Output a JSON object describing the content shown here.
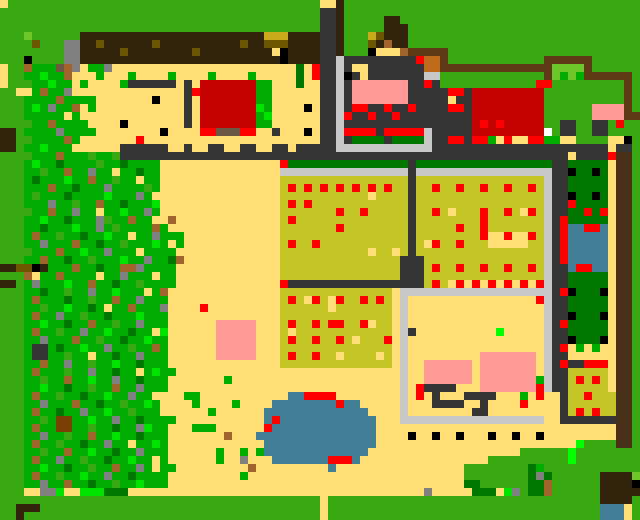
{
  "map": {
    "kind": "pixel-art-farm-map",
    "cell_size": 8,
    "grid": {
      "width": 80,
      "height": 65
    },
    "palette": {
      "G": "#38A811",
      "e": "#00AC00",
      "E": "#007800",
      "f": "#00E400",
      "F": "#00FF00",
      "L": "#6EC629",
      "T": "#FFDF73",
      "O": "#C4C426",
      "m": "#CBA91C",
      "o": "#6B5500",
      "D": "#32250B",
      "B": "#5E3A17",
      "x": "#4A3018",
      "b": "#A3652C",
      "v": "#7A3F00",
      "n": "#6B5744",
      "s": "#808080",
      "A": "#343434",
      "C": "#C8C8C8",
      "k": "#000000",
      "r": "#C40000",
      "R": "#FF0000",
      "P": "#FF9A99",
      "u": "#417E95",
      "c": "#C06A1E",
      "w": "#FFFFFF"
    },
    "rows_rle": [
      "1T 39G 2T 1D 37G",
      "40G 2A 1D 37G",
      "40G 2A 1D 5G 2D 30G",
      "40G 2A 1D 5G 3D 29G",
      "3G 1L 6G 23D 3m 4D 2A 1D 3G 1m 1o 3D 29G",
      "4G 1o 3G 2s 2D 1o 6D 1o 10D 1o 2D 3o 4D 2A 1D 3G 1o 1D 1b 2D 29G",
      "8G 2s 5D 1o 8D 1o 9D 1T 1k 4D 2A 1D 3G 1k 3T 1b 5B 24G",
      "3G 1k 4G 2s 25D 1k 4D 2A 1C 9A 1R 2c 1B 12G 6B 6G",
      "1T 2G 1b 3e 1n 1b 1s 1T 2e 1s 23T 1E 1T 1R 2A 1C 1A 2T 7A 2c 14B 4L 1B 6G",
      "1T 2G 2e 1f 2e 1b 3T 1e 3T 1e 4T 1e 4T 1e 4T 1e 5T 1E 1T 1R 2A 1C 1k 1A 1T 7A 2C 13G 1B 1L 1e 1L 1e 6B 1G",
      "1T 3G 2e 1f 2e 1T 1e 4T 1e 6A 1T 1A 1T 7r 2e 3T 1E 2T 2A 1C 1A 7P 2A 1R 1A 12G 2R 9G 1B 1G",
      "2G 2T 1e 1b 2e 1s 14T 1A 1R 7r 2e 6T 2A 1C 1A 7P 5A 2R 1A 9r 10G 1B 1G",
      "3G 4e 1b 4e 7T 1k 3T 1A 1T 7r 2e 6T 2A 1C 1A 7P 5A 1T 2A 9r 10G 1B 1G",
      "3G 1e 1f 1e 1s 2e 1b 1T 1e 11T 1A 1T 7r 1f 1e 4T 1k 1T 2A 1C 1A 2R 2A 1R 2A 1R 4A 2R 1A 9r 6G 4P 1B 1G",
      "3G 5e 1T 1e 13T 1A 1T 7r 1e 1f 6T 2A 1C 1R 2A 1R 2A 1R 9A 9r 6G 4P 2B",
      "4G 2e 1b 4e 4T 1k 7T 1A 1T 7r 2e 6T 2A 1C 16A 1r 1R 1r 1R 5r 2G 2A 2G 2A 1G 1R 2G",
      "2D 1G 4e 1s 4e 8T 1k 4T 2R 3n 2R 2T 1A 3T 1k 1T 2A 1C 4R 1A 5R 1C 5A 9r 1w 1G 2A 2G 2A 4G",
      "2D 2G 4e 1b 1e 7T 1R 22T 2A 1C 1A 4E 1A 4E 1C 2A 2R 1A 2R 1e 1T 1R 2T 2R 2e 2T 4G 2T 1k 1G",
      "2D 1G 2e 1f 3e 6T 6A 2T 1A 2T 2A 2T 2A 2T 2A 1T 5A 12C 22A 1T 2A 1G",
      "4G 3e 1b 3e 1G 2e 1G 56A 1T 4A 1R 2x 1G",
      "3G 1e 1f 2e 1E 4e 1G 2e 1E 4e 15T 1R 15E 1A 17E 2A 5E 1T 2x 1G",
      "3G 2e 1G 2e 1b 2e 1s 2e 1T 2e 1E 2e 15T 16C 1A 17C 2A 1k 2E 1k 1E 1T 2x 1G",
      "3G 1e 1E 3e 1f 2e 1b 2e 1G 2e 1T 2e 15T 16O 1A 16O 1C 2A 5E 1T 2x 1G",
      "3G 3e 1b 2e 1E 3e 1s 4e 1G 1e 15T 1O 1R 1O 1R 1O 1R 1O 1R 1O 1R 1O 1R 1O 1R 2O 1A 2O 1R 2O 1R 2O 1R 2O 1R 2O 1R 1O 1C 2A 5E 1T 2x 1G",
      "3G 1e 1G 3e 1E 4e 1f 3e 1s 1e 16T 11O 1T 4O 1A 16O 1C 2A 1k 2E 1k 1E 1T 2x 1G",
      "3G 3e 1s 2e 1G 2e 1b 2e 1E 3e 1f 15T 1O 1R 1O 1R 12O 1A 16O 1C 2A 1R 4E 1T 2x 1G",
      "4G 2e 1b 2e 1s 2e 1T 2e 1f 2e 1s 1e 15T 7O 1R 2O 1R 5O 1A 2O 1R 1O 1T 3O 1R 2O 1R 1O 1T 1R 1O 1C 2A 2E 1R 1E 1R 1T 2x 1G",
      "3G 2e 1f 2e 1E 3e 1s 1G 2e 1b 2e 2T 1b 13T 1O 1R 14O 1A 8O 1R 7O 1C 1A 1R 5E 1T 2x 1G",
      "3G 2e 1E 3e 1f 2e 1s 1e 1G 4e 1b 1e 14T 7O 1R 8O 1A 5O 1R 2O 1R 7O 1C 1A 1R 2u 2R 1u 1T 2x 1G",
      "3G 1e 1b 2e 1G 2e 1E 2e 1f 2e 1T 2e 1s 3e 12T 16O 1A 8O 1R 2T 1R 2T 1R 1O 1C 1A 1R 5u 1T 2x 1G",
      "3G 2e 1s 3e 1b 2e 1E 2e 1G 3e 1f 1e 1T 1e 12T 1O 1R 2O 1R 11O 1A 1O 1T 1R 2O 1R 3O 5T 2O 1C 1A 1R 5u 1T 2x 1G",
      "4G 3e 1b 2e 1f 2e 1s 3e 1T 2e 2e 13T 11O 1T 2O 1T 1O 1A 16O 1C 1A 1R 5u 1T 2x 1G",
      "3G 2e 1b 2e 1E 2e 1G 3e 1f 2e 1s 2e 1E 1b 12T 15O 3A 15O 1C 1A 1R 5u 1T 2x 1G",
      "2D 2o 1k 1D 3e 1b 2e 1E 2e 2b 1s 2e 2e 13T 15O 3A 1O 1R 2O 1R 2O 1R 2O 1R 2O 1R 1O 1C 2A 1u 2R 2u 1T 2x 1G",
      "3G 1b 1T 2e 1b 4e 1T 2e 1s 3e 1T 2e 13T 15O 3A 15O 1C 2A 5E 1T 2x 1G",
      "2D 1G 1e 1s 3e 1f 2e 1b 2e 1E 2e 1G 2e 2e 13T 1R 17A 1O 1R 1O 1T 1R 1T 1R 1T 1R 1T 1R 1T 1R 1T 1R 1C 2A 5E 1T 2x 1G",
      "3G 2e 1E 2e 1G 2e 1s 2e 1f 3e 1T 1e 1b 14T 14O 1T 19C 1A 1R 1k 3E 1k 1T 2x 1G",
      "3G 1e 1b 3e 1E 2e 1G 2e 1b 2e 1s 3e 14T 1O 1R 1O 1T 1R 1O 1T 1R 2O 1R 1O 1R 1O 1T 1C 16T 1R 1C 2A 5E 1T 2x 1G",
      "3G 2e 1G 2e 1f 2e 1E 1e 1T 2e 1b 3e 1s 4T 1R 9T 6O 1T 7O 1T 1C 17T 1C 2A 5E 1T 2x 1G",
      "3G 1e 1b 2e 1s 2e 1G 2e 1E 3e 1f 3e 14T 14O 1T 1C 17T 1C 2A 1k 3E 1k 1T 2x 1G",
      "3G 2e 1f 2e 1E 2e 1b 2e 1G 2e 1s 3e 6T 5P 3T 1O 1R 2O 1R 1O 2R 2O 1R 1T 2O 1T 1C 17T 1C 1A 1R 5E 1T 2x 1G",
      "3G 1e 1b 2e 1G 2e 1s 2e 1f 2e 1E 2e 1T 1f 6T 5P 3T 1O 1T 12O 1T 1C 1A 10T 1F 5T 1C 2A 5E 1T 2x 1G",
      "3G 2e 1s 3e 1b 2e 1G 2e 1E 2e 1f 2e 6T 5P 3T 1O 1R 2O 1R 2O 1R 1O 1T 3O 1R 1T 1C 17T 1C 2A 1k 3E 1k 1T 2x 1G",
      "3G 1e 2A 1e 1E 2e 1f 2e 1s 2e 1G 2e 1b 1e 6T 5P 3T 14O 1T 1C 17T 1C 1A 1R 1T 1e 1T 1e 2T 2x 1G",
      "3G 1e 2A 2e 1G 2e 1T 2e 1E 2e 1s 2e 1e 6T 5P 3T 1O 1R 2O 1R 2O 1T 4O 1T 1O 1T 1C 9T 7P 1T 1C 2A 6T 2x 1G",
      "3G 2e 1b 2e 1s 2e 1G 2e 1f 2e 1E 3e 14T 14O 1T 1C 2T 6P 1T 7P 1T 1C 1A 1R 2A 3R 1T 2x 1G",
      "3G 1e 1b 3e 1G 2e 1s 2e 1E 2e 1T 1e 1f 2e 28T 1C 2T 6P 1T 7P 1T 1C 2A 5O 1T 2x 1G",
      "3G 2e 1G 2e 1b 2e 1f 2e 1s 2e 1E 2e 1e 7T 1e 21T 1C 2T 6P 1T 7P 1e 1C 2A 1O 1R 1O 1R 1O 1T 2x 1G",
      "3G 2e 1f 2e 1E 2e 1G 2e 1b 2e 1s 2e 1e 29T 1C 1T 1R 4A 3T 7P 1R 1C 2A 5O 1T 2x 1G",
      "3G 1e 1b 2e 1G 2e 1E 2e 1f 2e 1s 2e 4T 2e 11T 2u 4R 8T 1C 1T 1R 1T 1A 3T 4A 3T 1e 1T 1R 2T 1A 2O 1R 3O 2x 1G",
      "3G 2e 1s 3e 1b 2e 1E 2e 1G 2e 1f 1e 4T 1e 4T 1e 4T 8u 1R 2u 5T 1C 3T 4A 2T 1A 4T 1R 4T 1A 6O 2x 1G",
      "3G 1e 1b 2e 1E 2e 1s 2e 1f 2e 1G 3e 6T 1e 6T 13u 4T 1C 8T 2A 9T 1A 1O 1R 1O 1R 2O 2x 1G",
      "3G 2e 1G 1e 2v 2e 1f 2e 1s 2e 1E 2e 2e 11T 1u 1R 12u 3T 18C 2T 7A 2x 1G",
      "3G 1e 1b 2e 2v 2e 1G 2e 1E 2e 1s 1f 1e 1e 3T 3e 6T 1R 13u 30T 2x 1G",
      "3G 2e 1s 2e 1G 2e 1b 2e 1f 2e 1E 2e 1e 7T 1b 3T 15u 4T 1k 2T 1k 2T 1k 3T 1k 2T 1k 2T 1k 9T 2x 1G",
      "3G 1e 1b 2e 1G 2e 1E 2e 1s 2e 1T 2e 1f 1e 12T 14u 25T 1F 4G 2x 1G",
      "3G 2e 1G 2e 1b 2e 1f 2e 1E 2e 1s 2e 1e 6T 1e 2T 1e 1T 1e 13u 19T 6G 1F 8G",
      "3G 1e 1b 2e 1s 2e 1G 2e 1E 2e 1f 2e 1T 1e 6T 1e 2T 1s 3T 7u 3R 1u 16T 10G 1F 8G",
      "3G 2e 1f 2e 1E 2e 1G 2e 1b 2e 1s 1e 1T 2e 9T 1b 9T 1u 16T 8G 1E 1e 12G",
      "3G 1e 1b 2e 1G 2e 1f 2e 1s 2e 1E 4e 9T 1e 27T 8G 1E 1s 1E 6G 4D 1L",
      "3G 2e 1s 2e 1b 2e 1E 2e 1G 2e 1f 3e 37T 2E 6G 2E 1b 6G 4D 1k",
      "3G 2T 2s 1f 2T 3f 3E 37T 1s 5T 3E 1T 1f 1s 1G 2E 1b 6G 5D",
      "40G 1T 34G 4D 1G",
      "2G 3D 35G 1T 34G 3u 1T 1G",
      "2G 1D 37G 1T 34G 3u 1T 1G"
    ]
  }
}
